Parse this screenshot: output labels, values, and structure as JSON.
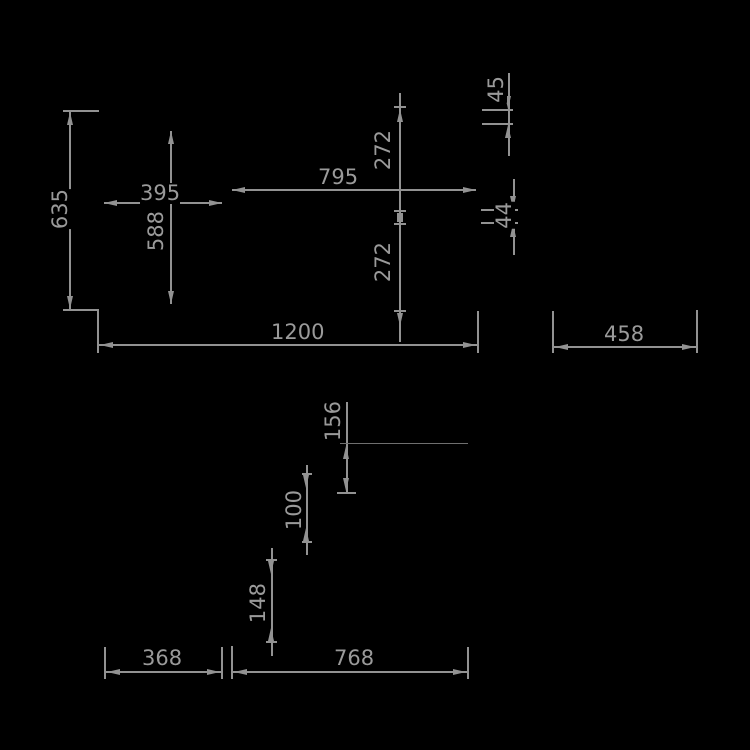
{
  "drawing": {
    "type": "technical-dimension-drawing",
    "background_color": "#000000",
    "line_color": "#929292",
    "text_color": "#9a9a9a",
    "dimensions": {
      "d635": {
        "label": "635",
        "orientation": "vertical"
      },
      "d395": {
        "label": "395",
        "orientation": "horizontal"
      },
      "d588": {
        "label": "588",
        "orientation": "vertical"
      },
      "d795": {
        "label": "795",
        "orientation": "horizontal"
      },
      "d272_upper": {
        "label": "272",
        "orientation": "vertical"
      },
      "d272_lower": {
        "label": "272",
        "orientation": "vertical"
      },
      "d45": {
        "label": "45",
        "orientation": "vertical"
      },
      "d44": {
        "label": "44",
        "orientation": "vertical"
      },
      "d1200": {
        "label": "1200",
        "orientation": "horizontal"
      },
      "d458": {
        "label": "458",
        "orientation": "horizontal"
      },
      "d156": {
        "label": "156",
        "orientation": "vertical"
      },
      "d100": {
        "label": "100",
        "orientation": "vertical"
      },
      "d148": {
        "label": "148",
        "orientation": "vertical"
      },
      "d368": {
        "label": "368",
        "orientation": "horizontal"
      },
      "d768": {
        "label": "768",
        "orientation": "horizontal"
      }
    }
  }
}
